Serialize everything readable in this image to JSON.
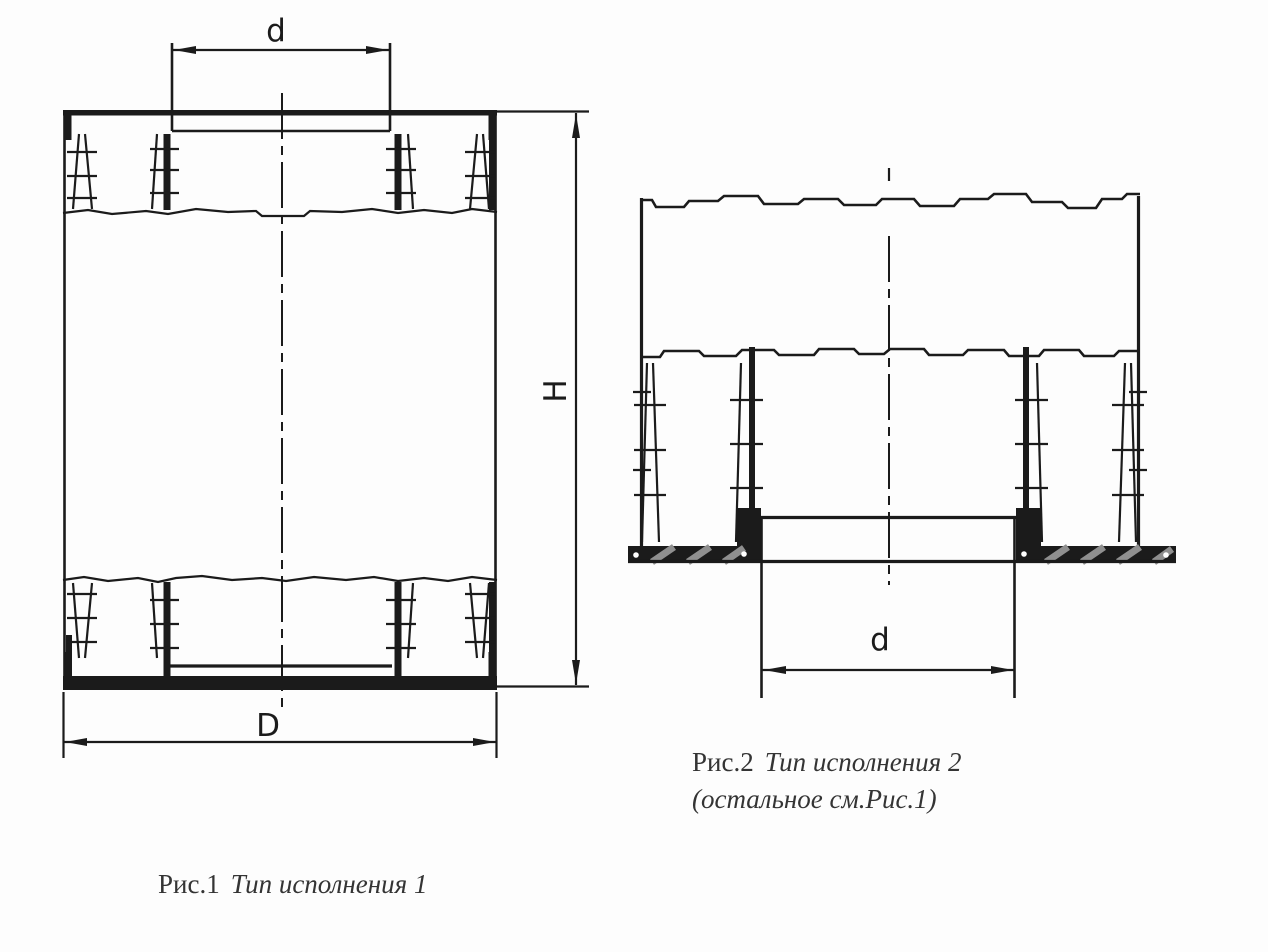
{
  "figures": {
    "fig1": {
      "caption": {
        "label": "Рис.1",
        "title": "Тип исполнения 1"
      },
      "dimensions": {
        "inner_diameter_top": "d",
        "height": "H",
        "outer_diameter": "D"
      }
    },
    "fig2": {
      "caption": {
        "label": "Рис.2",
        "title": "Тип исполнения 2",
        "note": "(остальное см.Рис.1)"
      },
      "dimensions": {
        "inner_diameter_bottom": "d"
      }
    }
  },
  "colors": {
    "line": "#1b1b1b",
    "background": "#fdfdfd",
    "caption_text": "#343434",
    "hatch": "#8f8f8f"
  }
}
